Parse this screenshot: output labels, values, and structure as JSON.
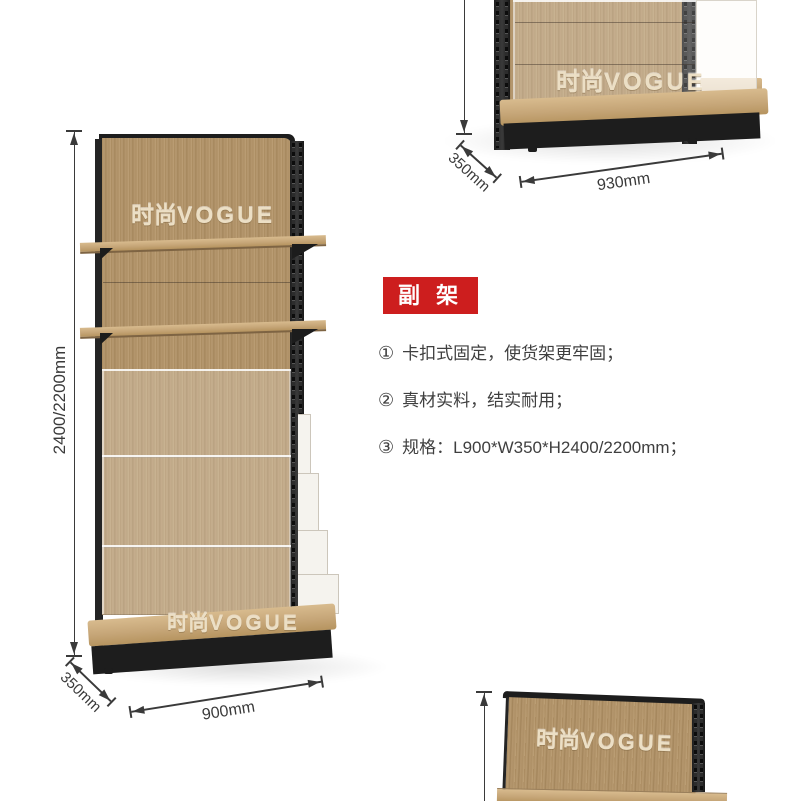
{
  "brand_watermark": {
    "cn": "时尚",
    "en": "VOGUE"
  },
  "info_panel": {
    "badge_label": "副 架",
    "features": [
      {
        "num": "①",
        "text": "卡扣式固定，使货架更牢固；"
      },
      {
        "num": "②",
        "text": "真材实料，结实耐用；"
      },
      {
        "num": "③",
        "text": "规格：L900*W350*H2400/2200mm；"
      }
    ]
  },
  "dimensions": {
    "main_rack": {
      "height": "2400/2200mm",
      "depth": "350mm",
      "width": "900mm"
    },
    "secondary_rack": {
      "depth": "350mm",
      "width": "930mm"
    }
  },
  "colors": {
    "badge_red": "#cd1e1e",
    "wood": "#b2946a",
    "frame_black": "#262626",
    "dim_text": "#3a3a3a",
    "watermark_cream": "#ecdfc5",
    "background": "#ffffff"
  }
}
